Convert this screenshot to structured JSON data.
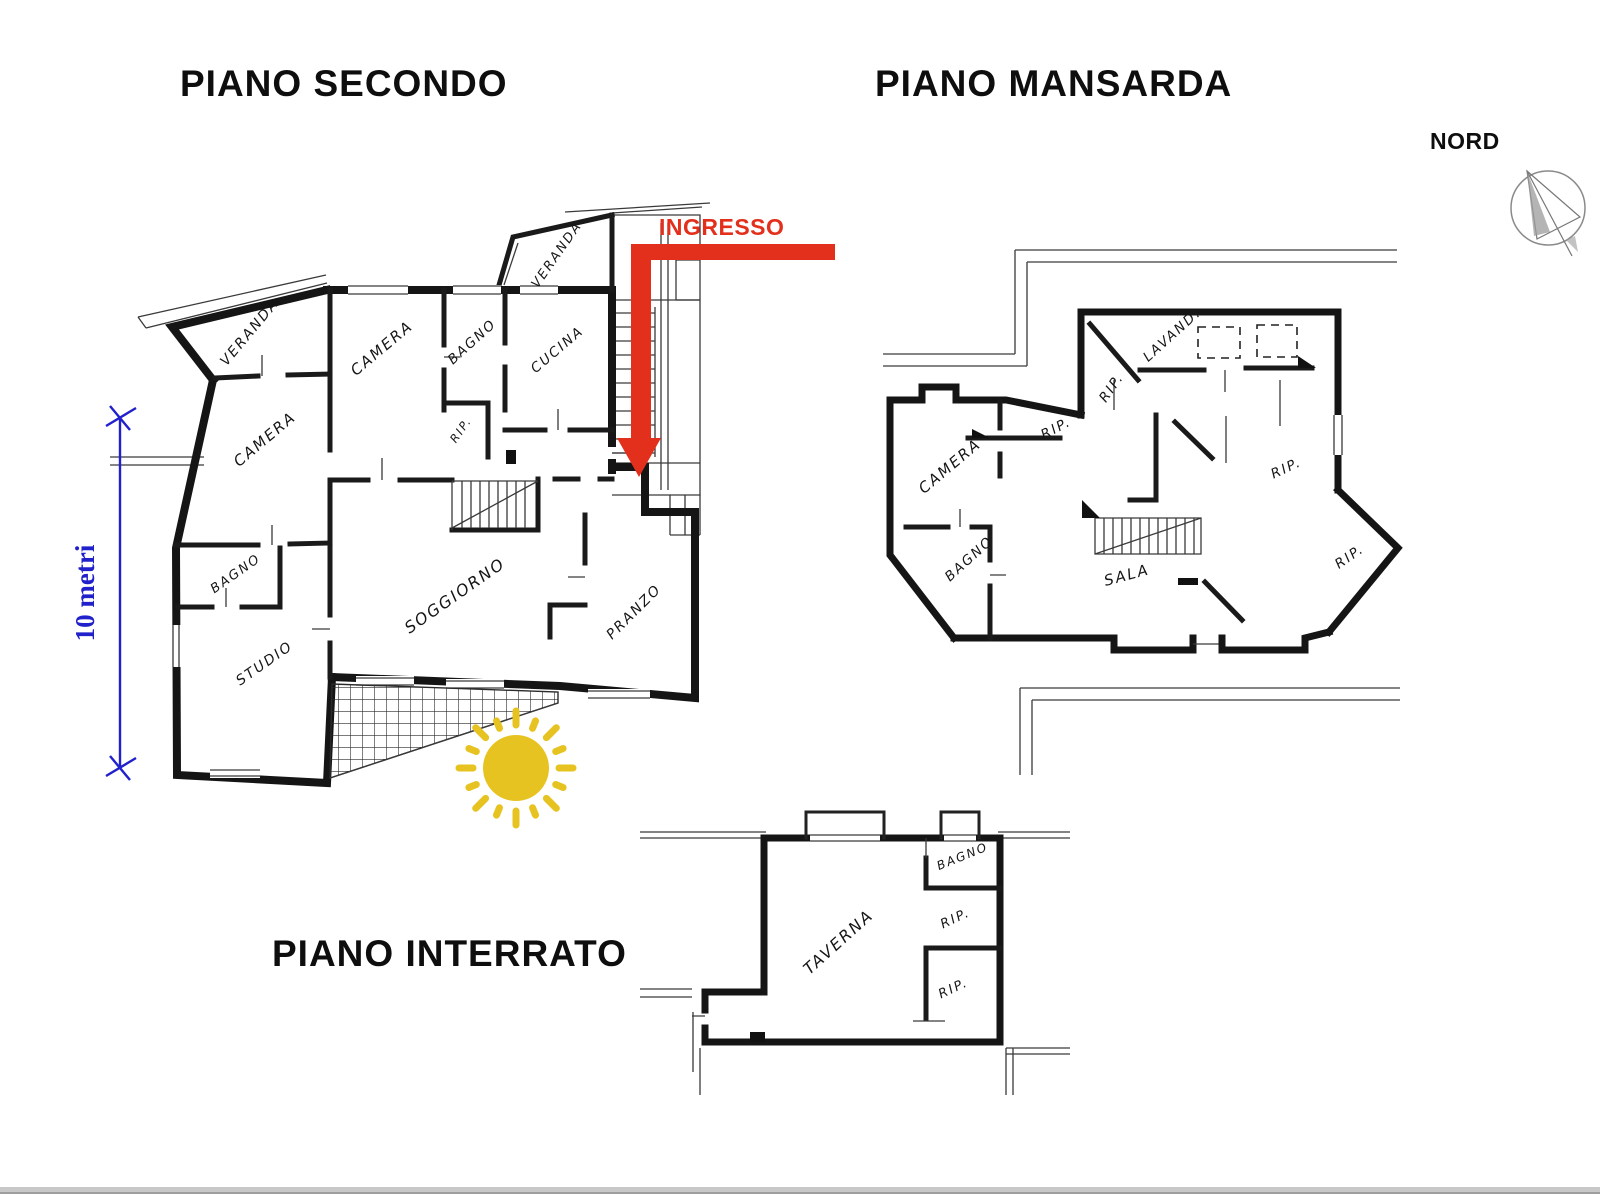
{
  "colors": {
    "ink": "#151515",
    "red": "#e2301c",
    "blue": "#2121cc",
    "sun": "#e7c322",
    "bottom_bar": "#c8c8c8"
  },
  "titles": {
    "secondo": "PIANO SECONDO",
    "mansarda": "PIANO MANSARDA",
    "interrato": "PIANO INTERRATO"
  },
  "annotations": {
    "ingresso": "INGRESSO",
    "nord": "NORD",
    "scale": "10 metri"
  },
  "floors": {
    "secondo": {
      "rooms": [
        {
          "label": "VERANDA"
        },
        {
          "label": "VERANDA"
        },
        {
          "label": "CAMERA"
        },
        {
          "label": "BAGNO"
        },
        {
          "label": "CUCINA"
        },
        {
          "label": "RIP."
        },
        {
          "label": "CAMERA"
        },
        {
          "label": "BAGNO"
        },
        {
          "label": "STUDIO"
        },
        {
          "label": "SOGGIORNO"
        },
        {
          "label": "PRANZO"
        }
      ]
    },
    "mansarda": {
      "rooms": [
        {
          "label": "RIP."
        },
        {
          "label": "LAVAND."
        },
        {
          "label": "CAMERA"
        },
        {
          "label": "RIP."
        },
        {
          "label": "BAGNO"
        },
        {
          "label": "SALA"
        },
        {
          "label": "RIP."
        },
        {
          "label": "RIP."
        }
      ]
    },
    "interrato": {
      "rooms": [
        {
          "label": "TAVERNA"
        },
        {
          "label": "BAGNO"
        },
        {
          "label": "RIP."
        },
        {
          "label": "RIP."
        }
      ]
    }
  }
}
